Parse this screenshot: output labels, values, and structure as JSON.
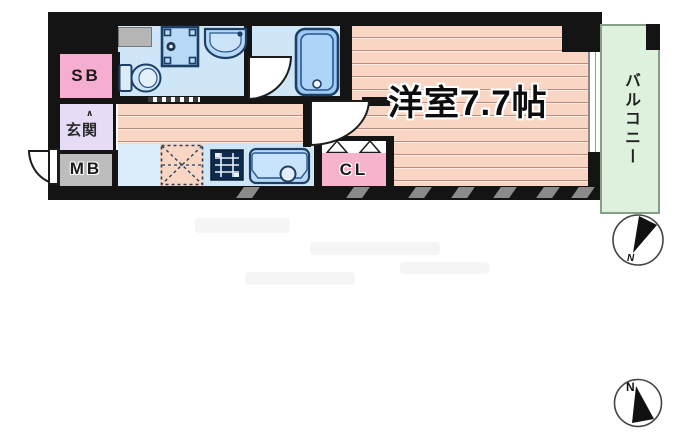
{
  "plan": {
    "type": "floor-plan",
    "labels": {
      "main_room": "洋室7.7帖",
      "balcony": "バルコニー",
      "entrance": "玄関",
      "entrance_step_mark": "∧",
      "storage_box": "SB",
      "meter_box": "MB",
      "closet": "CL"
    },
    "compass": {
      "north_label": "N"
    },
    "compass2": {
      "north_label": "N"
    },
    "colors": {
      "wall": "#141414",
      "flooring_base": "#f8d6c3",
      "flooring_line": "#c08a78",
      "wet_area": "#cfe6f8",
      "fixture_fill": "#b7d9f6",
      "fixture_border": "#1d3f66",
      "storage_pink": "#f6aed0",
      "entrance_lavender": "#e7dcf6",
      "meter_box_gray": "#bdbdbd",
      "balcony_green": "#def1dc",
      "balcony_border": "#85a085"
    }
  }
}
